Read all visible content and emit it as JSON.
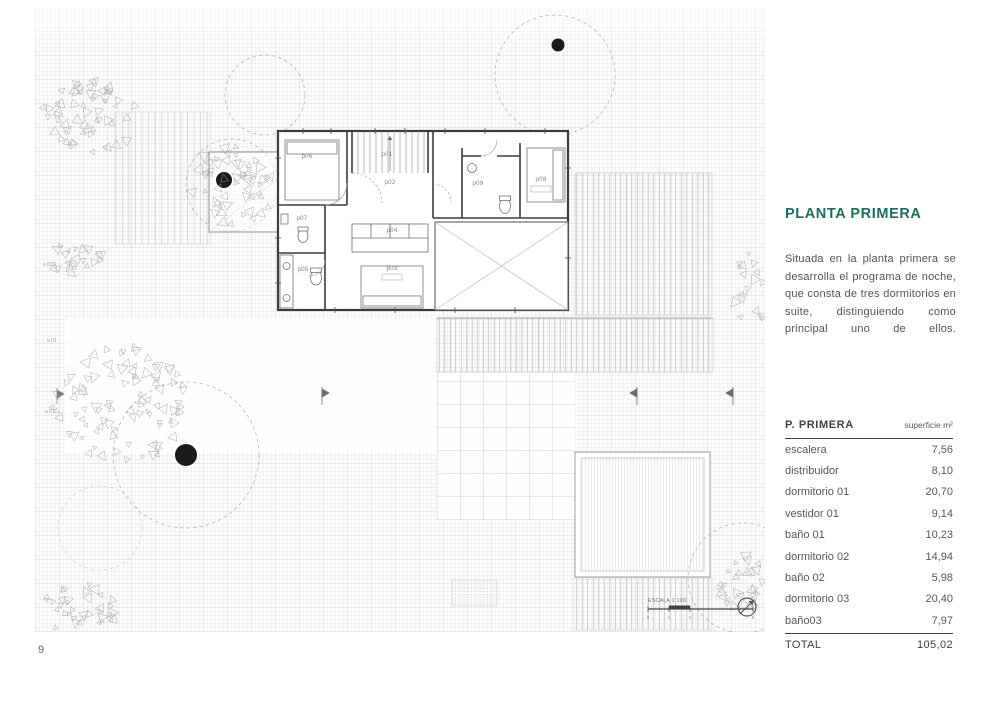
{
  "page": {
    "number": "9"
  },
  "sidebar": {
    "title": "PLANTA PRIMERA",
    "accent_color": "#1d6e58",
    "paragraph": "Situada en la planta primera se desarrolla el programa de noche, que consta de tres dormitorios en suite, distinguiendo como principal uno de ellos."
  },
  "table": {
    "header": {
      "name": "P. PRIMERA",
      "unit": "superficie m²"
    },
    "rows": [
      {
        "label": "escalera",
        "value": "7,56"
      },
      {
        "label": "distribuidor",
        "value": "8,10"
      },
      {
        "label": "dormitorio 01",
        "value": "20,70"
      },
      {
        "label": "vestidor 01",
        "value": "9,14"
      },
      {
        "label": "baño 01",
        "value": "10,23"
      },
      {
        "label": "dormitorio 02",
        "value": "14,94"
      },
      {
        "label": "baño 02",
        "value": "5,98"
      },
      {
        "label": "dormitorio 03",
        "value": "20,40"
      },
      {
        "label": "baño03",
        "value": "7,97"
      }
    ],
    "total": {
      "label": "TOTAL",
      "value": "105,02"
    }
  },
  "plan": {
    "rooms": [
      {
        "id": "p01",
        "label": "p01"
      },
      {
        "id": "p02",
        "label": "p02"
      },
      {
        "id": "p03",
        "label": "p03"
      },
      {
        "id": "p04",
        "label": "p04"
      },
      {
        "id": "p05",
        "label": "p05"
      },
      {
        "id": "p06",
        "label": "p06"
      },
      {
        "id": "p07",
        "label": "p07"
      },
      {
        "id": "p08",
        "label": "p08"
      },
      {
        "id": "p09",
        "label": "p09"
      }
    ],
    "site_labels": [
      "a 022",
      "a 01",
      "a 07"
    ],
    "scale_label": "ESCALA 1:100",
    "scale_ticks": [
      "0",
      "1",
      "2",
      "5"
    ]
  }
}
